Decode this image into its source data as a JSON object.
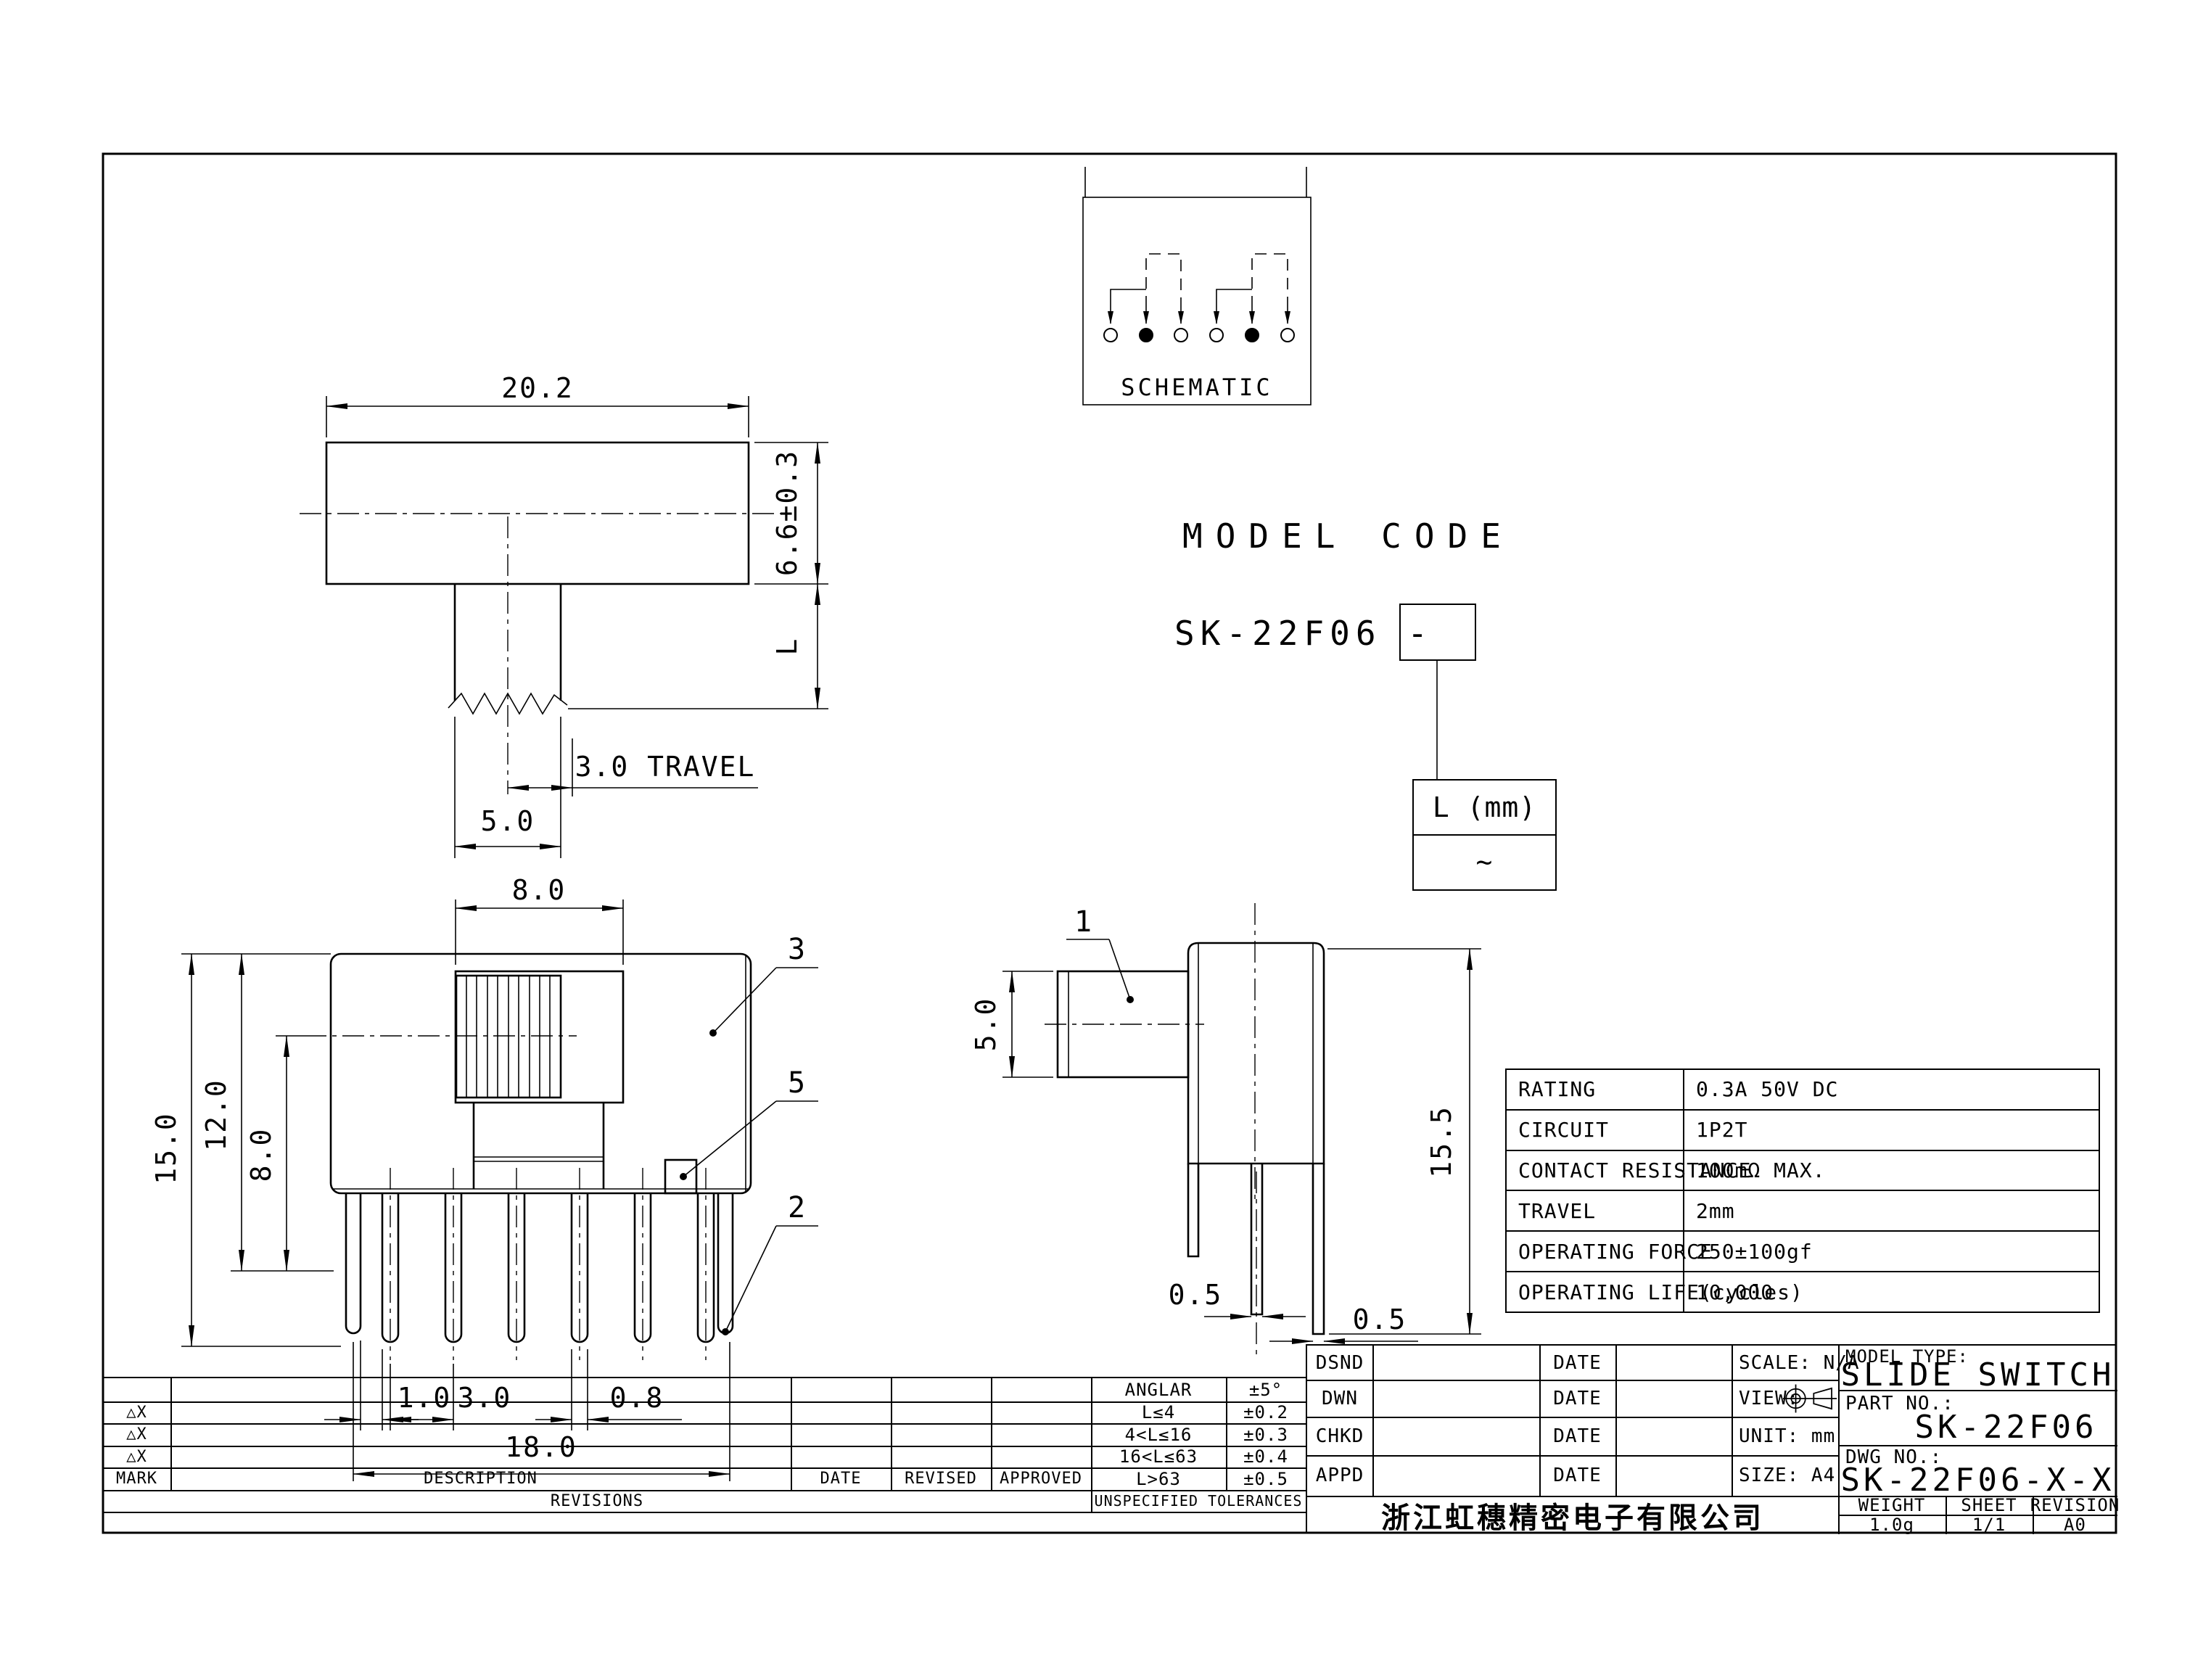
{
  "drawing": {
    "top_view": {
      "dim_width": "20.2",
      "dim_height": "6.6±0.3",
      "dim_shaft": "L",
      "dim_travel": "3.0 TRAVEL",
      "dim_knob": "5.0"
    },
    "schematic": {
      "label": "SCHEMATIC"
    },
    "model_code": {
      "title": "MODEL CODE",
      "code": "SK-22F06 -",
      "param_header": "L (mm)",
      "param_value": "~"
    },
    "front_view": {
      "dim_opening": "8.0",
      "dim_h1": "15.0",
      "dim_h2": "12.0",
      "dim_h3": "8.0",
      "dim_p1": "1.0",
      "dim_p2": "3.0",
      "dim_p3": "0.8",
      "dim_span": "18.0",
      "callout_cover": "3",
      "callout_base": "5",
      "callout_pin": "2"
    },
    "side_view": {
      "callout_knob": "1",
      "dim_knob": "5.0",
      "dim_height": "15.5",
      "dim_pin1": "0.5",
      "dim_pin2": "0.5"
    }
  },
  "spec_table": {
    "rows": [
      {
        "label": "RATING",
        "value": "0.3A 50V DC"
      },
      {
        "label": "CIRCUIT",
        "value": "1P2T"
      },
      {
        "label": "CONTACT RESISTANCE",
        "value": "100mΩ MAX."
      },
      {
        "label": "TRAVEL",
        "value": "2mm"
      },
      {
        "label": "OPERATING FORCE",
        "value": "250±100gf"
      },
      {
        "label": "OPERATING LIFE(cycles)",
        "value": "10,000"
      }
    ]
  },
  "tolerance_table": {
    "rows": [
      [
        "ANGLAR",
        "±5°"
      ],
      [
        "L≤4",
        "±0.2"
      ],
      [
        "4<L≤16",
        "±0.3"
      ],
      [
        "16<L≤63",
        "±0.4"
      ],
      [
        "L>63",
        "±0.5"
      ]
    ],
    "footer": "UNSPECIFIED TOLERANCES"
  },
  "revision_table": {
    "marks": [
      "△X",
      "△X",
      "△X"
    ],
    "headers": {
      "mark": "MARK",
      "description": "DESCRIPTION",
      "date": "DATE",
      "revised": "REVISED",
      "approved": "APPROVED"
    },
    "footer": "REVISIONS"
  },
  "title_block": {
    "sign_rows": [
      {
        "role": "DSND",
        "date": "DATE"
      },
      {
        "role": "DWN",
        "date": "DATE"
      },
      {
        "role": "CHKD",
        "date": "DATE"
      },
      {
        "role": "APPD",
        "date": "DATE"
      }
    ],
    "scale_label": "SCALE: N/A",
    "view_label": "VIEW:",
    "unit_label": "UNIT: mm",
    "size_label": "SIZE: A4",
    "model_type_label": "MODEL TYPE:",
    "model_type": "SLIDE SWITCH",
    "part_no_label": "PART NO.:",
    "part_no": "SK-22F06",
    "dwg_no_label": "DWG NO.:",
    "dwg_no": "SK-22F06-X-X",
    "weight_label": "WEIGHT",
    "sheet_label": "SHEET",
    "revision_label": "REVISION",
    "weight": "1.0g",
    "sheet": "1/1",
    "revision": "A0",
    "company": "浙江虹穗精密电子有限公司"
  }
}
